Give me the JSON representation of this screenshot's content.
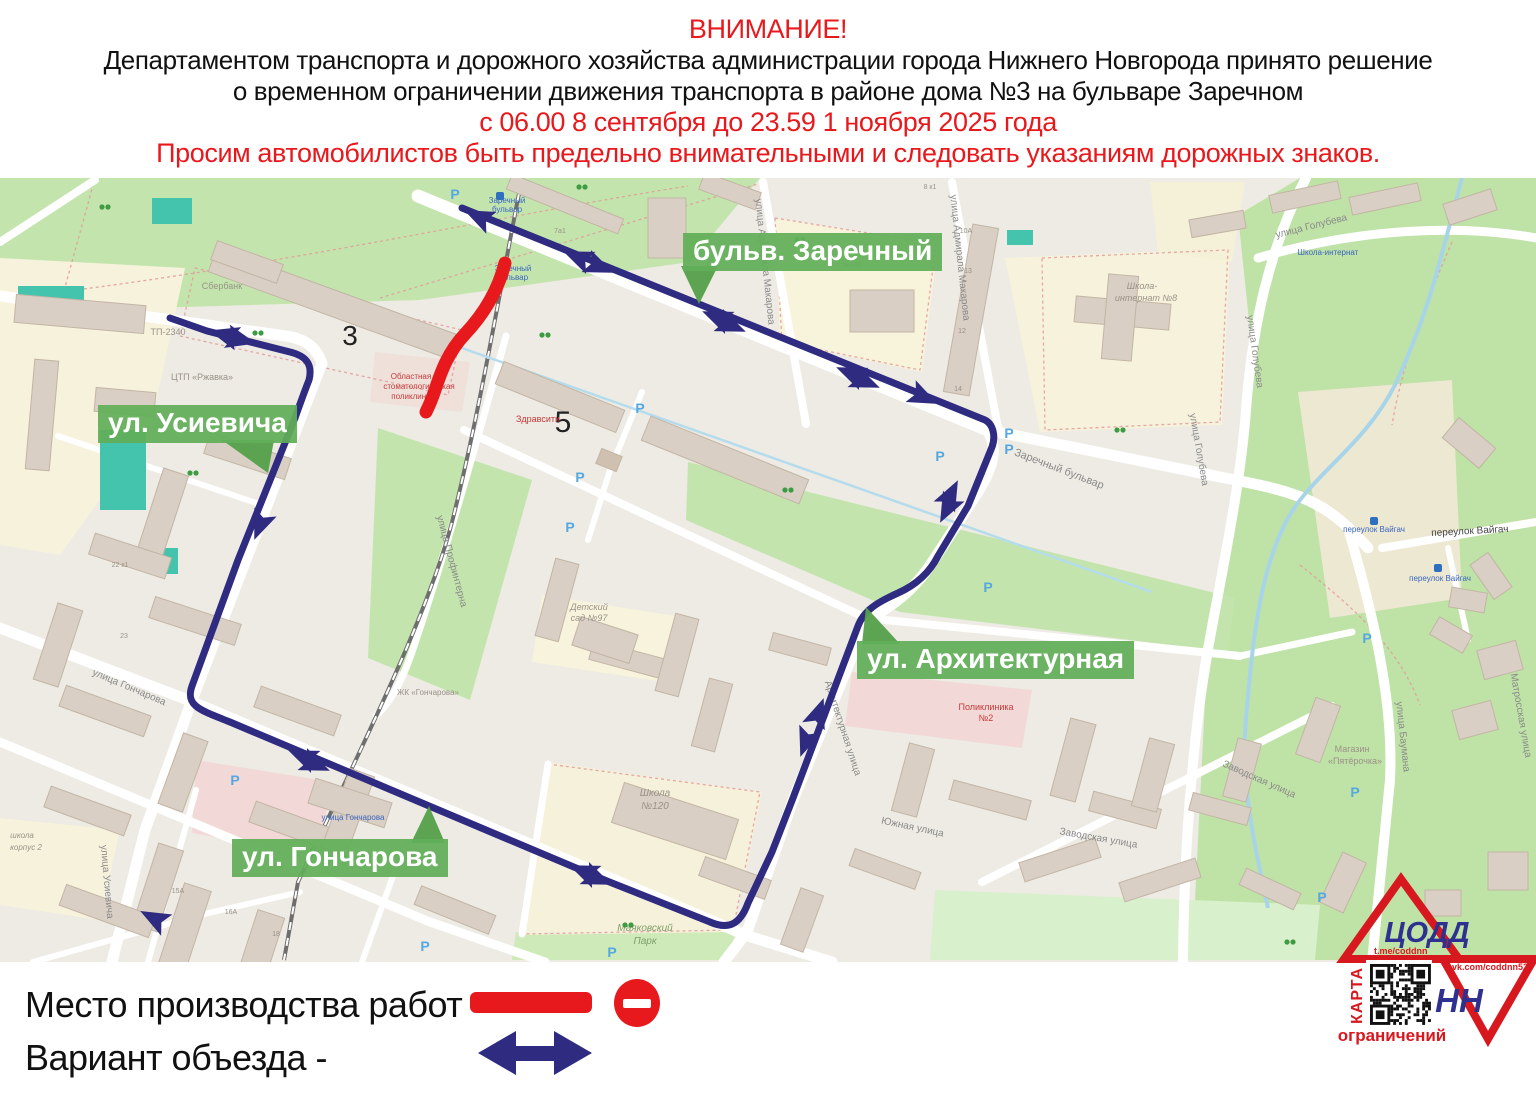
{
  "header": {
    "attention": "ВНИМАНИЕ!",
    "line1": "Департаментом транспорта и дорожного хозяйства администрации города Нижнего Новгорода принято решение",
    "line2": "о временном ограничении движения транспорта в районе дома №3 на бульваре Заречном",
    "dates": "с 06.00 8 сентября до 23.59 1 ноября 2025 года",
    "appeal": "Просим автомобилистов быть предельно внимательными и следовать указаниям дорожных знаков."
  },
  "legend": {
    "work_zone_label": "Место производства работ -",
    "detour_label": "Вариант объезда -"
  },
  "street_badges": {
    "zarechny": "бульв. Заречный",
    "usievicha": "ул. Усиевича",
    "arkhitekturnaya": "ул. Архитектурная",
    "goncharova": "ул. Гончарова"
  },
  "logo": {
    "org": "ЦОДД",
    "city": "НН",
    "telegram": "t.me/coddnn",
    "vk": "vk.com/coddnn52",
    "qr_side_caption": "КАРТА",
    "qr_bottom_caption": "ограничений"
  },
  "colors": {
    "alert_red": "#e8191d",
    "route_blue": "#2e2b80",
    "badge_green": "#61ae58",
    "logo_red": "#d7181f",
    "logo_blue": "#2f3190"
  },
  "map_labels": [
    {
      "t": "Заречный бульвар",
      "x": 1058,
      "y": 472,
      "r": 21,
      "s": 11,
      "c": "#8a8a8a"
    },
    {
      "t": "Заречный",
      "x": 507,
      "y": 203,
      "r": 0,
      "s": 8,
      "c": "#3a66c0"
    },
    {
      "t": "бульвар",
      "x": 507,
      "y": 212,
      "r": 0,
      "s": 8,
      "c": "#3a66c0"
    },
    {
      "t": "Заречный",
      "x": 513,
      "y": 271,
      "r": 0,
      "s": 8,
      "c": "#3a66c0"
    },
    {
      "t": "бульвар",
      "x": 513,
      "y": 280,
      "r": 0,
      "s": 8,
      "c": "#3a66c0"
    },
    {
      "t": "улица Адмирала Макарова",
      "x": 762,
      "y": 262,
      "r": 84,
      "s": 10,
      "c": "#8a8a8a"
    },
    {
      "t": "улица Адмирала Макарова",
      "x": 957,
      "y": 258,
      "r": 84,
      "s": 10,
      "c": "#8a8a8a"
    },
    {
      "t": "улица Голубева",
      "x": 1312,
      "y": 229,
      "r": -14,
      "s": 10,
      "c": "#8a8a8a"
    },
    {
      "t": "улица Голубева",
      "x": 1252,
      "y": 352,
      "r": 82,
      "s": 10,
      "c": "#8a8a8a"
    },
    {
      "t": "улица Голубева",
      "x": 1196,
      "y": 450,
      "r": 80,
      "s": 10,
      "c": "#8a8a8a"
    },
    {
      "t": "переулок Вайгач",
      "x": 1470,
      "y": 534,
      "r": -3,
      "s": 10,
      "c": "#444444"
    },
    {
      "t": "переулок Вайгач",
      "x": 1374,
      "y": 532,
      "r": 0,
      "s": 8,
      "c": "#3a66c0"
    },
    {
      "t": "переулок Вайгач",
      "x": 1440,
      "y": 581,
      "r": 0,
      "s": 8,
      "c": "#3a66c0"
    },
    {
      "t": "улица Баумана",
      "x": 1400,
      "y": 737,
      "r": 84,
      "s": 10,
      "c": "#8a8a8a"
    },
    {
      "t": "Матросская улица",
      "x": 1518,
      "y": 716,
      "r": 80,
      "s": 10,
      "c": "#8a8a8a"
    },
    {
      "t": "Заводская улица",
      "x": 1258,
      "y": 782,
      "r": 24,
      "s": 10,
      "c": "#8a8a8a"
    },
    {
      "t": "Заводская улица",
      "x": 1098,
      "y": 841,
      "r": 10,
      "s": 10,
      "c": "#8a8a8a"
    },
    {
      "t": "Южная улица",
      "x": 912,
      "y": 830,
      "r": 12,
      "s": 10,
      "c": "#8a8a8a"
    },
    {
      "t": "Архитектурная улица",
      "x": 840,
      "y": 729,
      "r": 72,
      "s": 10,
      "c": "#8a8a8a"
    },
    {
      "t": "улица Профинтерна",
      "x": 449,
      "y": 562,
      "r": 75,
      "s": 10,
      "c": "#8a8a8a"
    },
    {
      "t": "улица Гончарова",
      "x": 353,
      "y": 820,
      "r": 0,
      "s": 8,
      "c": "#3a66c0"
    },
    {
      "t": "улица Гончарова",
      "x": 128,
      "y": 690,
      "r": 23,
      "s": 10,
      "c": "#8a8a8a"
    },
    {
      "t": "улица Усиевича",
      "x": 104,
      "y": 882,
      "r": 85,
      "s": 10,
      "c": "#8a8a8a"
    },
    {
      "t": "ТП-2340",
      "x": 168,
      "y": 335,
      "r": 0,
      "s": 9,
      "c": "#9a9288"
    },
    {
      "t": "ЦТП «Ржавка»",
      "x": 202,
      "y": 380,
      "r": 0,
      "s": 9,
      "c": "#9a9288"
    },
    {
      "t": "Сбербанк",
      "x": 222,
      "y": 289,
      "r": 0,
      "s": 9,
      "c": "#9a9288"
    },
    {
      "t": "3",
      "x": 350,
      "y": 345,
      "r": 0,
      "s": 28,
      "c": "#222222"
    },
    {
      "t": "5",
      "x": 563,
      "y": 432,
      "r": 0,
      "s": 30,
      "c": "#222222"
    },
    {
      "t": "Здравсити",
      "x": 538,
      "y": 422,
      "r": 0,
      "s": 9,
      "c": "#c43a3a"
    },
    {
      "t": "Областная",
      "x": 411,
      "y": 379,
      "r": 0,
      "s": 8,
      "c": "#c43a3a"
    },
    {
      "t": "стоматологическая",
      "x": 419,
      "y": 389,
      "r": 0,
      "s": 8,
      "c": "#c43a3a"
    },
    {
      "t": "поликлиника",
      "x": 415,
      "y": 399,
      "r": 0,
      "s": 8,
      "c": "#c43a3a"
    },
    {
      "t": "Поликлиника",
      "x": 986,
      "y": 710,
      "r": 0,
      "s": 9,
      "c": "#c43a3a"
    },
    {
      "t": "№2",
      "x": 986,
      "y": 721,
      "r": 0,
      "s": 9,
      "c": "#c43a3a"
    },
    {
      "t": "Детский",
      "x": 589,
      "y": 610,
      "r": 0,
      "s": 9,
      "c": "#9a9288",
      "i": 1
    },
    {
      "t": "сад №97",
      "x": 589,
      "y": 621,
      "r": 0,
      "s": 9,
      "c": "#9a9288",
      "i": 1
    },
    {
      "t": "Школа",
      "x": 655,
      "y": 796,
      "r": 0,
      "s": 10,
      "c": "#9a9288",
      "i": 1
    },
    {
      "t": "№120",
      "x": 655,
      "y": 809,
      "r": 0,
      "s": 10,
      "c": "#9a9288",
      "i": 1
    },
    {
      "t": "Маяковский",
      "x": 645,
      "y": 931,
      "r": 0,
      "s": 10,
      "c": "#7fa06a",
      "i": 1
    },
    {
      "t": "Парк",
      "x": 645,
      "y": 944,
      "r": 0,
      "s": 10,
      "c": "#7fa06a",
      "i": 1
    },
    {
      "t": "Школа-",
      "x": 1142,
      "y": 289,
      "r": 0,
      "s": 9,
      "c": "#9a9288",
      "i": 1
    },
    {
      "t": "интернат №8",
      "x": 1146,
      "y": 301,
      "r": 0,
      "s": 9,
      "c": "#9a9288",
      "i": 1
    },
    {
      "t": "Школа-интернат",
      "x": 1328,
      "y": 255,
      "r": 0,
      "s": 8,
      "c": "#3a66c0"
    },
    {
      "t": "ЖК «Гончарова»",
      "x": 428,
      "y": 695,
      "r": 0,
      "s": 8,
      "c": "#9a9288"
    },
    {
      "t": "Магазин",
      "x": 1352,
      "y": 752,
      "r": 0,
      "s": 9,
      "c": "#9a9288"
    },
    {
      "t": "«Пятёрочка»",
      "x": 1355,
      "y": 764,
      "r": 0,
      "s": 9,
      "c": "#9a9288"
    },
    {
      "t": "школа",
      "x": 22,
      "y": 838,
      "r": 0,
      "s": 8,
      "c": "#9a9288",
      "i": 1
    },
    {
      "t": "корпус 2",
      "x": 26,
      "y": 850,
      "r": 0,
      "s": 8,
      "c": "#9a9288",
      "i": 1
    },
    {
      "t": "10А",
      "x": 966,
      "y": 233,
      "r": 0,
      "s": 7,
      "c": "#9a9288"
    },
    {
      "t": "13",
      "x": 968,
      "y": 273,
      "r": 0,
      "s": 7,
      "c": "#9a9288"
    },
    {
      "t": "12",
      "x": 962,
      "y": 333,
      "r": 0,
      "s": 7,
      "c": "#9a9288"
    },
    {
      "t": "14",
      "x": 958,
      "y": 391,
      "r": 0,
      "s": 7,
      "c": "#9a9288"
    },
    {
      "t": "№100",
      "x": 852,
      "y": 267,
      "r": 0,
      "s": 7,
      "c": "#9a9288"
    },
    {
      "t": "8 к1",
      "x": 930,
      "y": 189,
      "r": 0,
      "s": 7,
      "c": "#9a9288"
    },
    {
      "t": "7а1",
      "x": 560,
      "y": 233,
      "r": 0,
      "s": 7,
      "c": "#9a9288"
    },
    {
      "t": "15А",
      "x": 178,
      "y": 893,
      "r": 0,
      "s": 7,
      "c": "#9a9288"
    },
    {
      "t": "16А",
      "x": 231,
      "y": 914,
      "r": 0,
      "s": 7,
      "c": "#9a9288"
    },
    {
      "t": "18",
      "x": 276,
      "y": 936,
      "r": 0,
      "s": 7,
      "c": "#9a9288"
    },
    {
      "t": "22 к1",
      "x": 120,
      "y": 567,
      "r": 0,
      "s": 7,
      "c": "#9a9288"
    },
    {
      "t": "23",
      "x": 124,
      "y": 638,
      "r": 0,
      "s": 7,
      "c": "#9a9288"
    }
  ]
}
